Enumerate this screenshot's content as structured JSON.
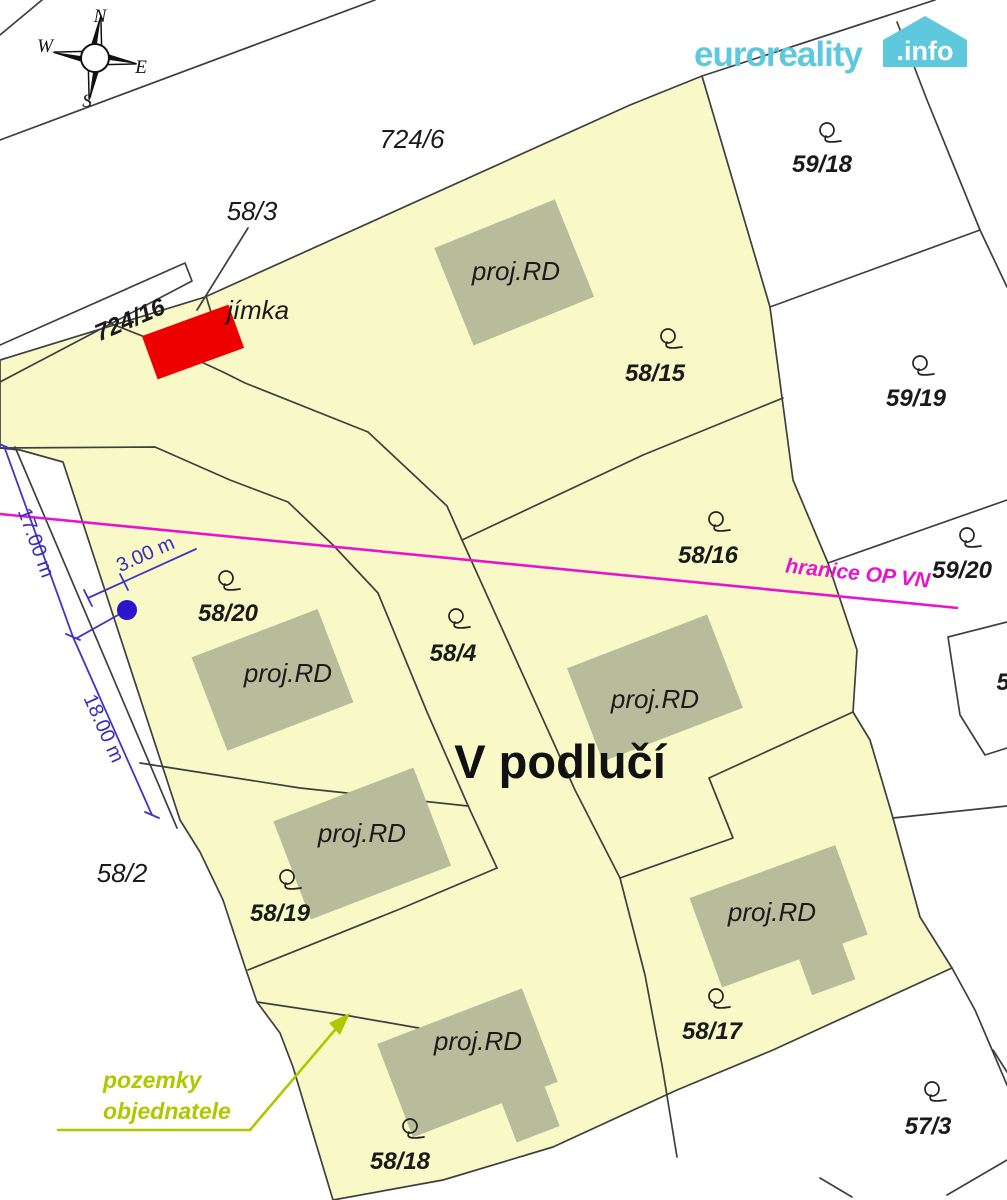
{
  "logo": {
    "brand": "euroreality",
    "badge": ".info",
    "brand_color": "#5ec9dd"
  },
  "compass": {
    "north": "N",
    "south": "S",
    "east": "E",
    "west": "W"
  },
  "map_title": {
    "locality": "V podlučí"
  },
  "parcels": {
    "p724_6": "724/6",
    "p724_16": "724/16",
    "p58_3": "58/3",
    "p58_2": "58/2",
    "p58_4": "58/4",
    "p58_15": "58/15",
    "p58_16": "58/16",
    "p58_17": "58/17",
    "p58_18": "58/18",
    "p58_19": "58/19",
    "p58_20": "58/20",
    "p59_18": "59/18",
    "p59_19": "59/19",
    "p59_20": "59/20",
    "p57_3": "57/3",
    "p5_partial": "5"
  },
  "buildings": {
    "label": "proj.RD"
  },
  "annotations": {
    "jimka": "jímka",
    "hranice": "hranice OP VN",
    "pozemky_line1": "pozemky",
    "pozemky_line2": "objednatele"
  },
  "dimensions": {
    "d17": "17.00 m",
    "d3": "3.00 m",
    "d18": "18.00 m"
  },
  "colors": {
    "parcel_fill": "#f8f9c6",
    "building_fill": "#b9bc9b",
    "boundary": "#3f3f3f",
    "red_tank": "#ee0000",
    "magenta_line": "#e714ce",
    "dim_blue": "#4034c6",
    "dot_blue": "#2d15cd",
    "arrow_green": "#aec800",
    "logo_blue": "#5ec9dd"
  }
}
